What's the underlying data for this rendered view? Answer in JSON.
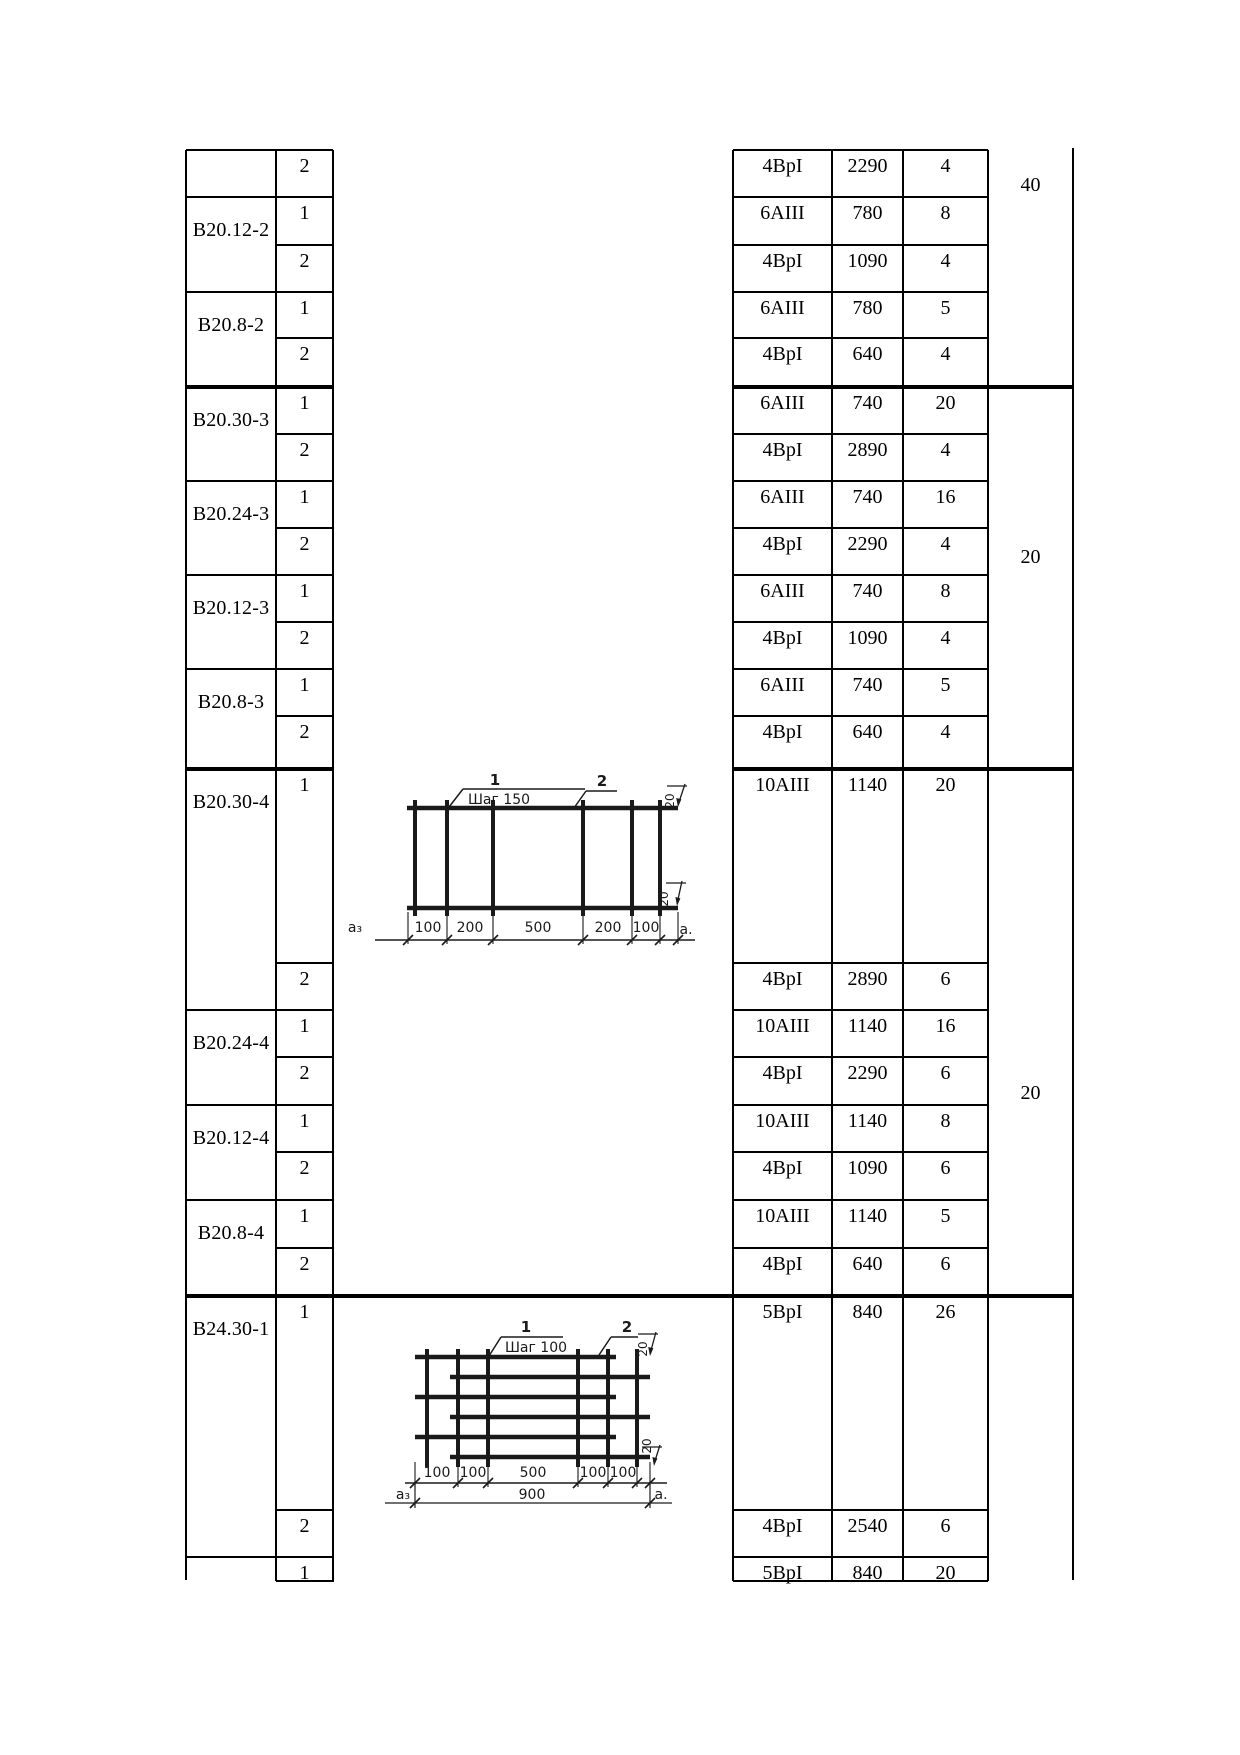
{
  "style": {
    "ink": "#000000",
    "paper": "#ffffff",
    "diagram_ink": "#1a1a1a"
  },
  "table": {
    "blocks": [
      {
        "mark": "",
        "rows": [
          {
            "pos": "2",
            "rebar": "4BpI",
            "length": "2290",
            "qty": "4"
          }
        ]
      },
      {
        "mark": "B20.12-2",
        "rows": [
          {
            "pos": "1",
            "rebar": "6AIII",
            "length": "780",
            "qty": "8"
          },
          {
            "pos": "2",
            "rebar": "4BpI",
            "length": "1090",
            "qty": "4"
          }
        ]
      },
      {
        "mark": "B20.8-2",
        "rows": [
          {
            "pos": "1",
            "rebar": "6AIII",
            "length": "780",
            "qty": "5"
          },
          {
            "pos": "2",
            "rebar": "4BpI",
            "length": "640",
            "qty": "4"
          }
        ]
      },
      {
        "mark": "B20.30-3",
        "rows": [
          {
            "pos": "1",
            "rebar": "6AIII",
            "length": "740",
            "qty": "20"
          },
          {
            "pos": "2",
            "rebar": "4BpI",
            "length": "2890",
            "qty": "4"
          }
        ]
      },
      {
        "mark": "B20.24-3",
        "rows": [
          {
            "pos": "1",
            "rebar": "6AIII",
            "length": "740",
            "qty": "16"
          },
          {
            "pos": "2",
            "rebar": "4BpI",
            "length": "2290",
            "qty": "4"
          }
        ]
      },
      {
        "mark": "B20.12-3",
        "rows": [
          {
            "pos": "1",
            "rebar": "6AIII",
            "length": "740",
            "qty": "8"
          },
          {
            "pos": "2",
            "rebar": "4BpI",
            "length": "1090",
            "qty": "4"
          }
        ]
      },
      {
        "mark": "B20.8-3",
        "rows": [
          {
            "pos": "1",
            "rebar": "6AIII",
            "length": "740",
            "qty": "5"
          },
          {
            "pos": "2",
            "rebar": "4BpI",
            "length": "640",
            "qty": "4"
          }
        ]
      },
      {
        "mark": "B20.30-4",
        "rows": [
          {
            "pos": "1",
            "rebar": "10AIII",
            "length": "1140",
            "qty": "20"
          },
          {
            "pos": "2",
            "rebar": "4BpI",
            "length": "2890",
            "qty": "6"
          }
        ]
      },
      {
        "mark": "B20.24-4",
        "rows": [
          {
            "pos": "1",
            "rebar": "10AIII",
            "length": "1140",
            "qty": "16"
          },
          {
            "pos": "2",
            "rebar": "4BpI",
            "length": "2290",
            "qty": "6"
          }
        ]
      },
      {
        "mark": "B20.12-4",
        "rows": [
          {
            "pos": "1",
            "rebar": "10AIII",
            "length": "1140",
            "qty": "8"
          },
          {
            "pos": "2",
            "rebar": "4BpI",
            "length": "1090",
            "qty": "6"
          }
        ]
      },
      {
        "mark": "B20.8-4",
        "rows": [
          {
            "pos": "1",
            "rebar": "10AIII",
            "length": "1140",
            "qty": "5"
          },
          {
            "pos": "2",
            "rebar": "4BpI",
            "length": "640",
            "qty": "6"
          }
        ]
      },
      {
        "mark": "B24.30-1",
        "rows": [
          {
            "pos": "1",
            "rebar": "5BpI",
            "length": "840",
            "qty": "26"
          },
          {
            "pos": "2",
            "rebar": "4BpI",
            "length": "2540",
            "qty": "6"
          }
        ]
      },
      {
        "mark": "",
        "rows": [
          {
            "pos": "1",
            "rebar": "5BpI",
            "length": "840",
            "qty": "20"
          }
        ]
      }
    ]
  },
  "series_counts": [
    {
      "value": "40"
    },
    {
      "value": "20"
    },
    {
      "value": "20"
    },
    {
      "value": ""
    }
  ],
  "diagrams": [
    {
      "callout_1": "1",
      "pitch_label": "Шаг 150",
      "callout_2": "2",
      "overhang_top": "20",
      "overhang_bottom": "20",
      "segment_dims": [
        "100",
        "200",
        "500",
        "200",
        "100"
      ],
      "left_anchor": "a₃",
      "right_anchor": "a."
    },
    {
      "callout_1": "1",
      "pitch_label": "Шаг 100",
      "callout_2": "2",
      "overhang_top": "20",
      "overhang_bottom": "20",
      "segment_dims": [
        "100",
        "100",
        "500",
        "100",
        "100"
      ],
      "total_dim": "900",
      "left_anchor": "a₃",
      "right_anchor": "a."
    }
  ]
}
